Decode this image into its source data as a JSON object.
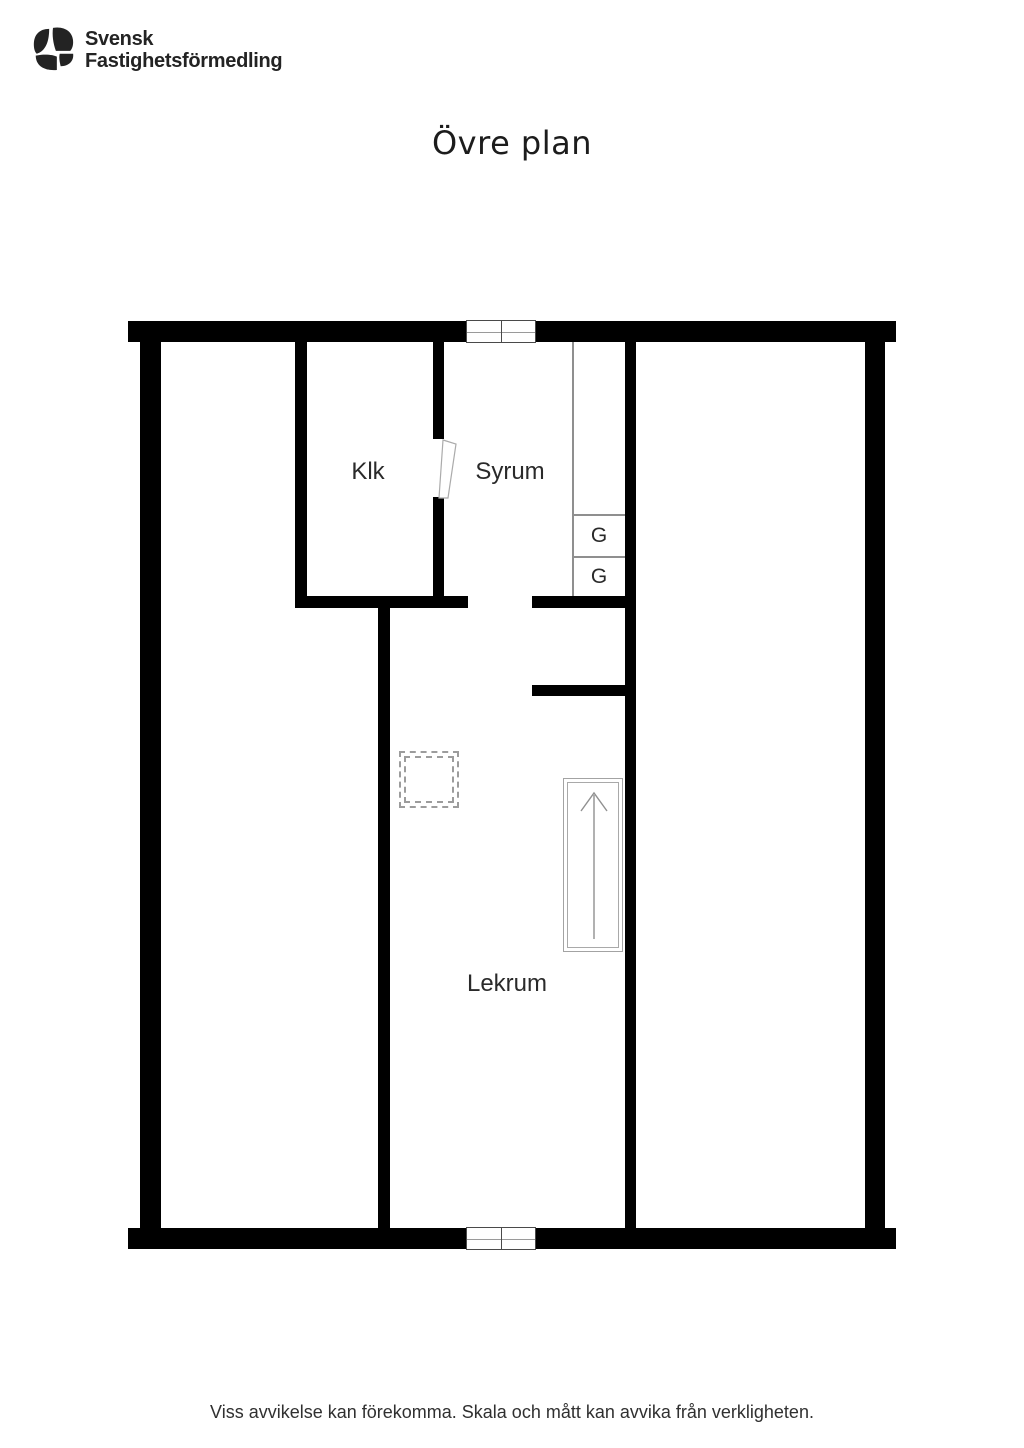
{
  "header": {
    "logo": {
      "icon": "sf-monogram-icon",
      "line1": "Svensk",
      "line2": "Fastighetsförmedling"
    }
  },
  "page_title": "Övre plan",
  "floorplan": {
    "rooms": [
      {
        "label": "Klk"
      },
      {
        "label": "Syrum"
      },
      {
        "label": "Lekrum"
      }
    ],
    "closets": [
      {
        "label": "G"
      },
      {
        "label": "G"
      }
    ],
    "features": [
      "window-top",
      "window-bottom",
      "door-swing-klk",
      "wardrobe-column",
      "chimney-dashed-outline",
      "staircase-arrow-up"
    ]
  },
  "footer": {
    "disclaimer": "Viss avvikelse kan förekomma. Skala och mått kan avvika från verkligheten."
  },
  "colors": {
    "wall": "#000000",
    "thin_line": "#8f8f8f",
    "dashed": "#9c9c9c",
    "text": "#222222",
    "background": "#ffffff"
  }
}
